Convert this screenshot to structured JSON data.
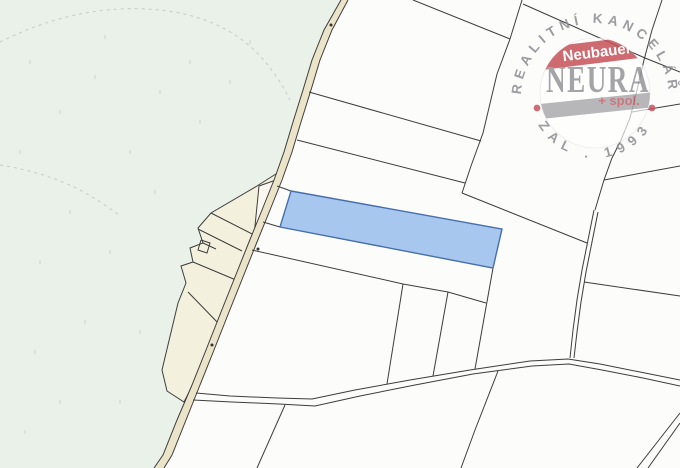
{
  "map": {
    "kind": "cadastral parcel map with highlighted parcel",
    "colors": {
      "forest": "#e9f1e8",
      "farmstead": "#f4f0de",
      "road_fill": "#ebe4c8",
      "parcel_white": "#fcfcfb",
      "boundary_line": "#3d3d3d",
      "highlight_fill": "#a8c7ee",
      "highlight_border": "#466fae"
    }
  },
  "watermark": {
    "arc_top": "REALITNÍ KANCELÁŘ",
    "arc_bottom": "ZAL . 1993",
    "band_text": "Neubauer",
    "brand": "NEURA",
    "suffix": "+ spol.",
    "colors": {
      "band_red": "#c6525a",
      "brand_gray": "#95949a",
      "arc_gray": "#8c8c91",
      "dot_red": "#c4555e"
    }
  }
}
